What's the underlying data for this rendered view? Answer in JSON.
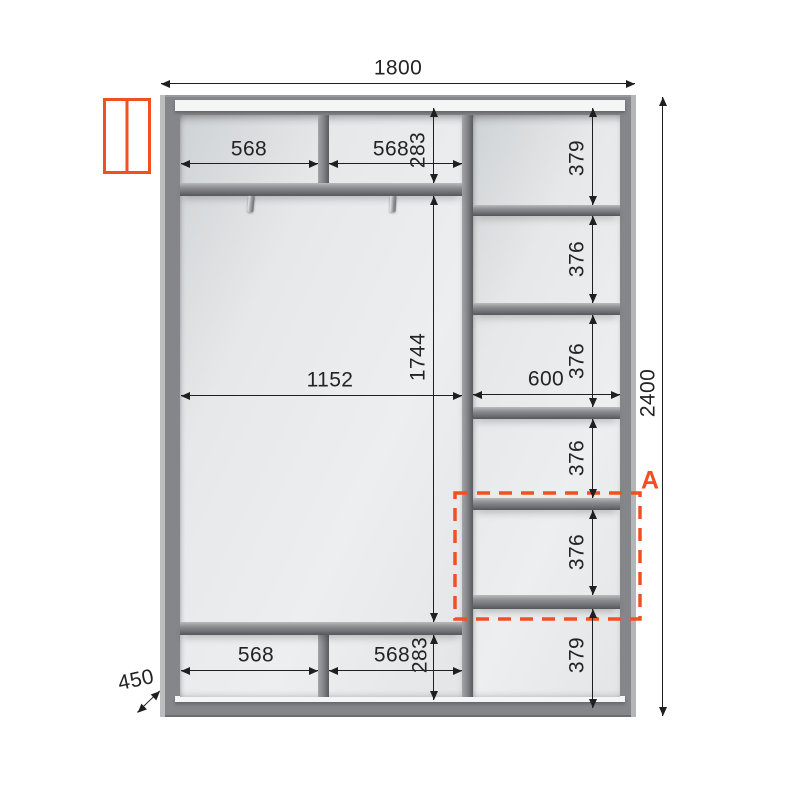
{
  "meta": {
    "type": "wardrobe-dimension-drawing"
  },
  "colors": {
    "accent": "#f25022",
    "frame": "#84868a",
    "shelf": "#8d8f92",
    "interior": "#e8eaec",
    "line": "#1f1f1f"
  },
  "icon": {
    "name": "sliding-door-wardrobe-icon"
  },
  "section": {
    "label": "A"
  },
  "dims": {
    "width": "1800",
    "height": "2400",
    "depth": "450",
    "top_shelf_left": "568",
    "top_shelf_right": "568",
    "top_height": "283",
    "interior_width": "1152",
    "interior_height": "1744",
    "column_width": "600",
    "column_heights": [
      "379",
      "376",
      "376",
      "376",
      "376",
      "379"
    ],
    "bottom_shelf_left": "568",
    "bottom_shelf_right": "568",
    "bottom_height": "283"
  }
}
